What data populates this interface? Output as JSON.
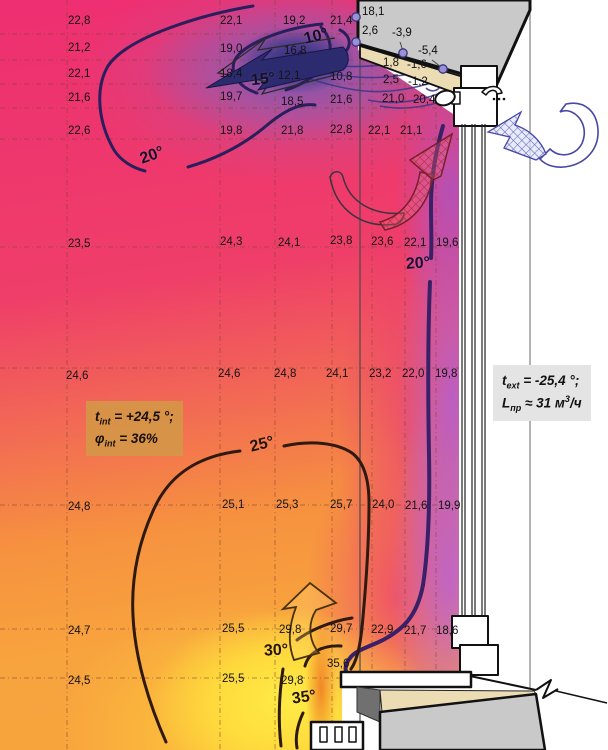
{
  "diagram_title": "Temperature field and air flow pattern at a window section",
  "colors": {
    "hot_yellow": "#ffe23c",
    "warm_orange": "#f8a43e",
    "pink_magenta": "#ee2f72",
    "cold_violet": "#b65ccd",
    "cold_jet_navy": "#2c2a6e",
    "wall_gray": "#c9c9c9",
    "insulation_beige": "#ecdcb4",
    "info_box_tan": "#d59648",
    "info_box_gray": "#e4e4e4",
    "flow_arrow_blue": "#4747a8",
    "isotherm_cold": "#241b54",
    "isotherm_warm": "#241505"
  },
  "boxes": {
    "interior": {
      "l1_var": "t",
      "l1_sub": "int",
      "l1_eq": " =  +24,5 °;",
      "l2_var": "φ",
      "l2_sub": "int",
      "l2_eq": " = 36%"
    },
    "exterior": {
      "l1_var": "t",
      "l1_sub": "ext",
      "l1_eq": " =  -25,4 °;",
      "l2_var": "L",
      "l2_sub": "пр",
      "l2_a": " ≈ 31 м",
      "l2_sup": "3",
      "l2_b": "/ч"
    }
  },
  "isotherm_labels": [
    {
      "t": "10°",
      "x": 304,
      "y": 29,
      "r": -14,
      "c": "#15102a"
    },
    {
      "t": "15°",
      "x": 251,
      "y": 72,
      "r": -6,
      "c": "#15102a"
    },
    {
      "t": "20°",
      "x": 140,
      "y": 148,
      "r": -20,
      "c": "#15102a"
    },
    {
      "t": "20°",
      "x": 406,
      "y": 256,
      "r": -4,
      "c": "#1b1038"
    },
    {
      "t": "25°",
      "x": 250,
      "y": 437,
      "r": -14,
      "c": "#241505"
    },
    {
      "t": "30°",
      "x": 264,
      "y": 643,
      "r": -3,
      "c": "#241505"
    },
    {
      "t": "35°",
      "x": 292,
      "y": 690,
      "r": -8,
      "c": "#241505"
    }
  ],
  "wall_point_values": [
    {
      "x": 362,
      "y": 7,
      "v": "18,1"
    },
    {
      "x": 362,
      "y": 26,
      "v": "2,6"
    },
    {
      "x": 392,
      "y": 28,
      "v": "-3,9"
    },
    {
      "x": 418,
      "y": 46,
      "v": "-5,4"
    }
  ],
  "grid_values": [
    {
      "x": 68,
      "y": 16,
      "v": "22,8"
    },
    {
      "x": 220,
      "y": 16,
      "v": "22,1"
    },
    {
      "x": 283,
      "y": 16,
      "v": "19,2"
    },
    {
      "x": 330,
      "y": 16,
      "v": "21,4"
    },
    {
      "x": 68,
      "y": 43,
      "v": "21,2"
    },
    {
      "x": 220,
      "y": 44,
      "v": "19,0"
    },
    {
      "x": 284,
      "y": 46,
      "v": "16,8"
    },
    {
      "x": 68,
      "y": 69,
      "v": "22,1"
    },
    {
      "x": 220,
      "y": 69,
      "v": "18,4"
    },
    {
      "x": 278,
      "y": 71,
      "v": "12,1"
    },
    {
      "x": 330,
      "y": 72,
      "v": "10,8"
    },
    {
      "x": 383,
      "y": 58,
      "v": "1,8"
    },
    {
      "x": 407,
      "y": 60,
      "v": "-1,6"
    },
    {
      "x": 383,
      "y": 75,
      "v": "2,5"
    },
    {
      "x": 408,
      "y": 77,
      "v": "-1,2"
    },
    {
      "x": 68,
      "y": 93,
      "v": "21,6"
    },
    {
      "x": 220,
      "y": 92,
      "v": "19,7"
    },
    {
      "x": 281,
      "y": 97,
      "v": "18,5"
    },
    {
      "x": 330,
      "y": 95,
      "v": "21,6"
    },
    {
      "x": 382,
      "y": 94,
      "v": "21,0"
    },
    {
      "x": 413,
      "y": 95,
      "v": "20,4"
    },
    {
      "x": 68,
      "y": 126,
      "v": "22,6"
    },
    {
      "x": 220,
      "y": 126,
      "v": "19,8"
    },
    {
      "x": 281,
      "y": 126,
      "v": "21,8"
    },
    {
      "x": 330,
      "y": 125,
      "v": "22,8"
    },
    {
      "x": 368,
      "y": 126,
      "v": "22,1"
    },
    {
      "x": 400,
      "y": 126,
      "v": "21,1"
    },
    {
      "x": 68,
      "y": 239,
      "v": "23,5"
    },
    {
      "x": 220,
      "y": 237,
      "v": "24,3"
    },
    {
      "x": 278,
      "y": 238,
      "v": "24,1"
    },
    {
      "x": 330,
      "y": 236,
      "v": "23,8"
    },
    {
      "x": 371,
      "y": 237,
      "v": "23,6"
    },
    {
      "x": 404,
      "y": 238,
      "v": "22,1"
    },
    {
      "x": 436,
      "y": 238,
      "v": "19,6"
    },
    {
      "x": 66,
      "y": 371,
      "v": "24,6"
    },
    {
      "x": 218,
      "y": 369,
      "v": "24,6"
    },
    {
      "x": 274,
      "y": 369,
      "v": "24,8"
    },
    {
      "x": 326,
      "y": 369,
      "v": "24,1"
    },
    {
      "x": 369,
      "y": 369,
      "v": "23,2"
    },
    {
      "x": 402,
      "y": 369,
      "v": "22,0"
    },
    {
      "x": 435,
      "y": 369,
      "v": "19,8"
    },
    {
      "x": 68,
      "y": 502,
      "v": "24,8"
    },
    {
      "x": 222,
      "y": 500,
      "v": "25,1"
    },
    {
      "x": 276,
      "y": 500,
      "v": "25,3"
    },
    {
      "x": 330,
      "y": 500,
      "v": "25,7"
    },
    {
      "x": 372,
      "y": 500,
      "v": "24,0"
    },
    {
      "x": 405,
      "y": 501,
      "v": "21,6"
    },
    {
      "x": 438,
      "y": 501,
      "v": "19,9"
    },
    {
      "x": 68,
      "y": 626,
      "v": "24,7"
    },
    {
      "x": 222,
      "y": 624,
      "v": "25,5"
    },
    {
      "x": 279,
      "y": 625,
      "v": "29,8"
    },
    {
      "x": 330,
      "y": 624,
      "v": "29,7"
    },
    {
      "x": 371,
      "y": 625,
      "v": "22,9"
    },
    {
      "x": 404,
      "y": 626,
      "v": "21,7"
    },
    {
      "x": 436,
      "y": 626,
      "v": "18,6"
    },
    {
      "x": 68,
      "y": 676,
      "v": "24,5"
    },
    {
      "x": 222,
      "y": 674,
      "v": "25,5"
    },
    {
      "x": 281,
      "y": 676,
      "v": "29,8"
    },
    {
      "x": 327,
      "y": 659,
      "v": "35,6"
    }
  ]
}
